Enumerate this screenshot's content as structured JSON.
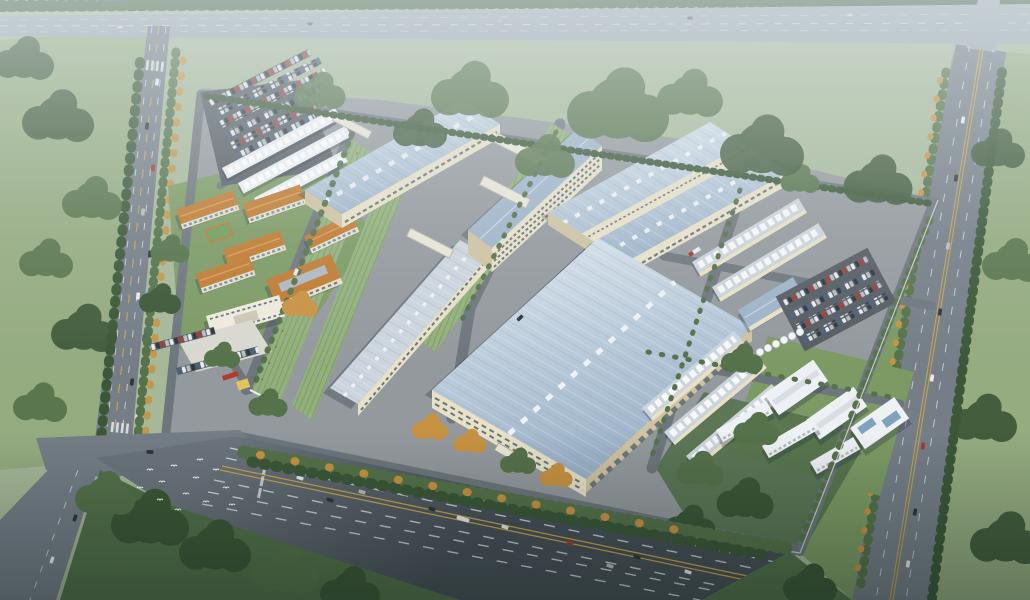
{
  "image": {
    "type": "aerial-3d-architectural-rendering",
    "subject": "industrial park campus with warehouses, dormitories and surrounding roads",
    "width_px": 1030,
    "height_px": 600,
    "weather": "hazy daylight"
  },
  "palette": {
    "fieldTop": "#a7b899",
    "fieldSide": "#95ab80",
    "lawn": "#7d9a64",
    "lawnDark": "#52704a",
    "treeGreen": "#55724a",
    "treeDark": "#3c5737",
    "treeAutumn": "#c89243",
    "roadTop": "#9aa6ae",
    "roadMain": "#757e87",
    "roadDark": "#4e565e",
    "roadInternal": "#6e767d",
    "parking": "#555c63",
    "laneWhite": "#e6eaed",
    "laneYellow": "#c3a24d",
    "concrete": "#94999d",
    "plaza": "#d9d9d1",
    "roofBlueLight": "#dce6ee",
    "roofBlueDark": "#9fb4c9",
    "roofRib": "#8ba0b6",
    "roofSilver": "#ccd5dd",
    "wallCream": "#e8e1c8",
    "wallCreamShade": "#cfc3a2",
    "windowDark": "#50626f",
    "roofOrange": "#c07b31",
    "roofOrangeLight": "#da9a4f",
    "greenStrip": "#93b07c",
    "greenStripLine": "#6f9459",
    "whiteBldg": "#eef1f3",
    "whiteBldgShade": "#c2cbd2",
    "tank": "#f3f5f7",
    "glassBlue": "#7fa3bd",
    "carWhite": "#e8ebee",
    "carDark": "#2f353b",
    "carRed": "#a8392e",
    "carSilver": "#b7bec5",
    "carBlue": "#46627e",
    "bird": "#f4f6f7",
    "shadow": "rgba(35,50,65,0.30)"
  },
  "scene": {
    "view": "aerial oblique bird's-eye view",
    "campus": {
      "large_warehouses": 4,
      "support_slab_buildings": 2,
      "dormitory_blocks": 5,
      "canteen_buildings": 1,
      "admin_buildings": 1,
      "entrance_gates": 1,
      "green_louver_strips": 3,
      "footbridges": 4,
      "workshop_rows": 8,
      "storage_tanks": 6,
      "utility_buildings": 3,
      "southeast_office_buildings": 3,
      "parking_lots": 3,
      "basketball_courts": 1
    },
    "surroundings": {
      "north_highway": true,
      "south_highway": true,
      "west_avenue": true,
      "east_road": true,
      "tree_belts": true,
      "bird_flock": true,
      "vehicle_traffic": true
    }
  }
}
